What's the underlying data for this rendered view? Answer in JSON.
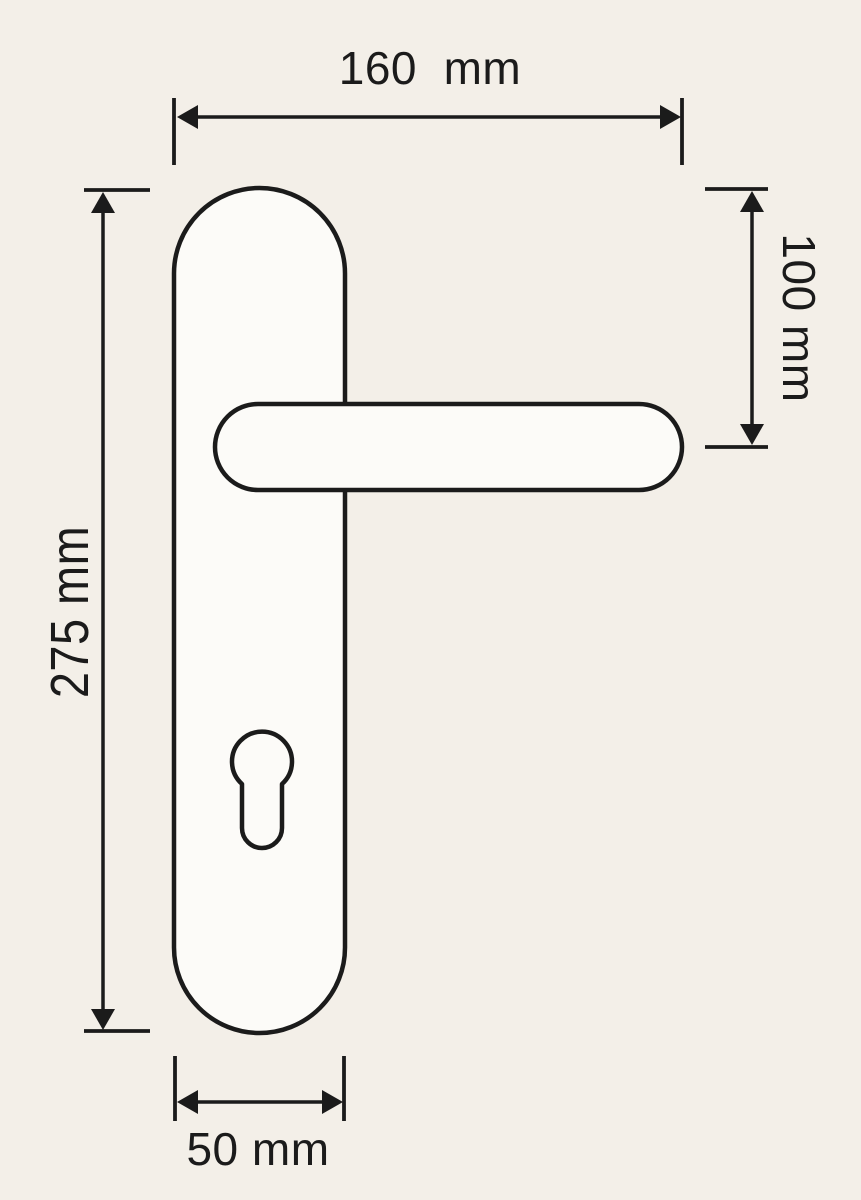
{
  "drawing": {
    "labels": {
      "width_total": "160  mm",
      "backset_height": "100 mm",
      "height_total": "275 mm",
      "plate_width": "50 mm"
    },
    "colors": {
      "background": "#f3efe8",
      "line": "#1b1b1b",
      "fill": "#fcfbf8"
    }
  }
}
